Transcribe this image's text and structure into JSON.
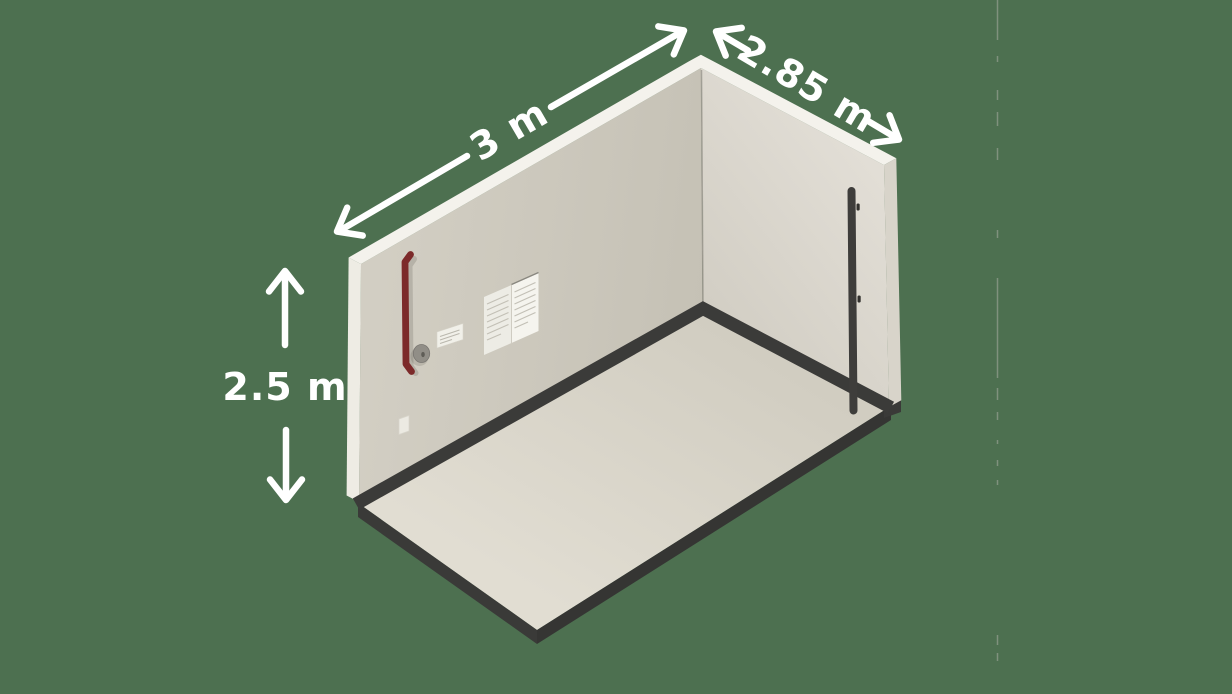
{
  "scene": {
    "name": "storage-room-size-illustration",
    "background_color": "#4d7050",
    "labels": {
      "width": {
        "text": "3 m",
        "rotation_deg": -30
      },
      "depth": {
        "text": "2.85 m",
        "rotation_deg": 30
      },
      "height": {
        "text": "2.5 m",
        "rotation_deg": 0
      }
    },
    "colors": {
      "background": "#4d7050",
      "wall_left_face": "#cbc7bb",
      "wall_right_face": "#dedad2",
      "edge_highlight": "#f4f2ec",
      "wall_side_shaded": "#d8d4ca",
      "floor": "#dcd8cc",
      "plinth_dark": "#3a3a38",
      "grab_bar_red": "#7c2a2a",
      "pole_dark": "#3e3d3b",
      "sign_paper": "#f2f1ea",
      "disc_gray": "#918e87",
      "arrow_and_text": "#ffffff"
    },
    "objects": [
      "left wall",
      "right wall",
      "floor slab",
      "red grab bar",
      "round wall disc",
      "small info sign",
      "large info sign (two pages)",
      "light switch",
      "dark wall pole"
    ]
  }
}
